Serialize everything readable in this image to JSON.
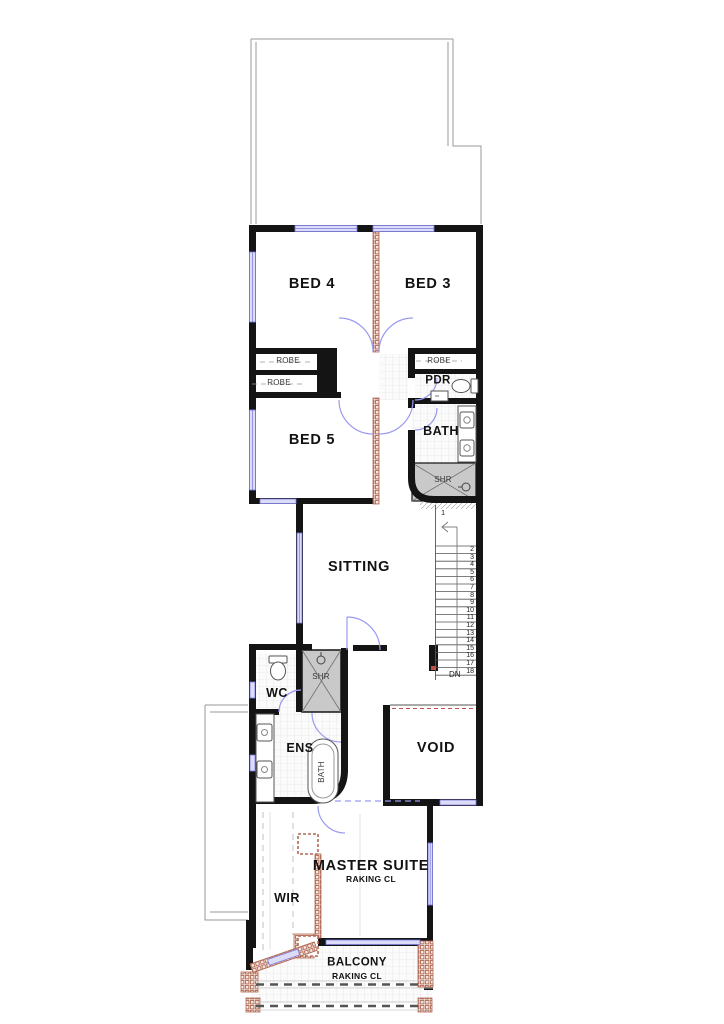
{
  "labels": {
    "bed4": "BED 4",
    "bed3": "BED 3",
    "bed5": "BED 5",
    "robe_a": "ROBE",
    "robe_b": "ROBE",
    "robe_c": "ROBE",
    "pdr": "PDR",
    "bath": "BATH",
    "shr_bath": "SHR",
    "sitting": "SITTING",
    "wc": "WC",
    "ens": "ENS",
    "shr_ens": "SHR",
    "tub": "BATH",
    "void": "VOID",
    "master": "MASTER SUITE",
    "master_ceiling": "RAKING CL",
    "wir": "WIR",
    "balcony": "BALCONY",
    "balcony_ceiling": "RAKING CL",
    "stair_first": "1",
    "stair_dn": "DN"
  },
  "stairs": {
    "steps": [
      "2",
      "3",
      "4",
      "5",
      "6",
      "7",
      "8",
      "9",
      "10",
      "11",
      "12",
      "13",
      "14",
      "15",
      "16",
      "17",
      "18"
    ]
  },
  "colors": {
    "wall": "#141414",
    "window_fill": "#dcdcf8",
    "window_stroke": "#7a7ae0",
    "stud_wall": "#b06a55",
    "shower_fill": "#c9c9c9",
    "tile_line": "#dddddd",
    "red_dash": "#c0504d"
  }
}
